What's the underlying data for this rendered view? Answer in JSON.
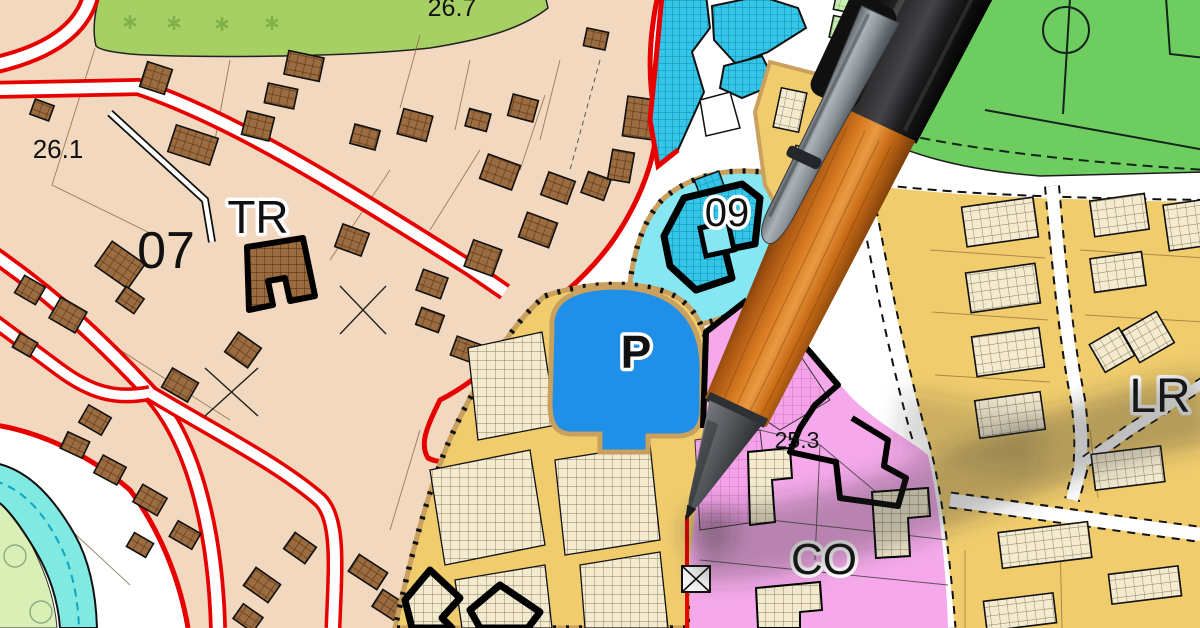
{
  "map": {
    "labels": {
      "park": "26.7",
      "parcel_26_1": "26.1",
      "zone_07": "07",
      "zone_tr": "TR",
      "zone_09": "09",
      "parking": "P",
      "zone_lr": "LR",
      "parcel_25_3": "25.3",
      "zone_co": "CO"
    },
    "legend_colors": {
      "residential_beige": "#f2d8bf",
      "building_brown": "#9b6c3f",
      "park_green": "#a6d063",
      "sports_field_green": "#6dcd61",
      "riverside_green": "#d9efb5",
      "river_cyan": "#7fe9e2",
      "mixed_use_cyan": "#35c5e8",
      "zone09_cyan_light": "#86e6f2",
      "parking_blue": "#1f8fe8",
      "residential_golden": "#f0cc6d",
      "building_pale_yellow": "#f3ead0",
      "commercial_pink": "#f5a9ea",
      "road_outline_red": "#e60000"
    }
  }
}
